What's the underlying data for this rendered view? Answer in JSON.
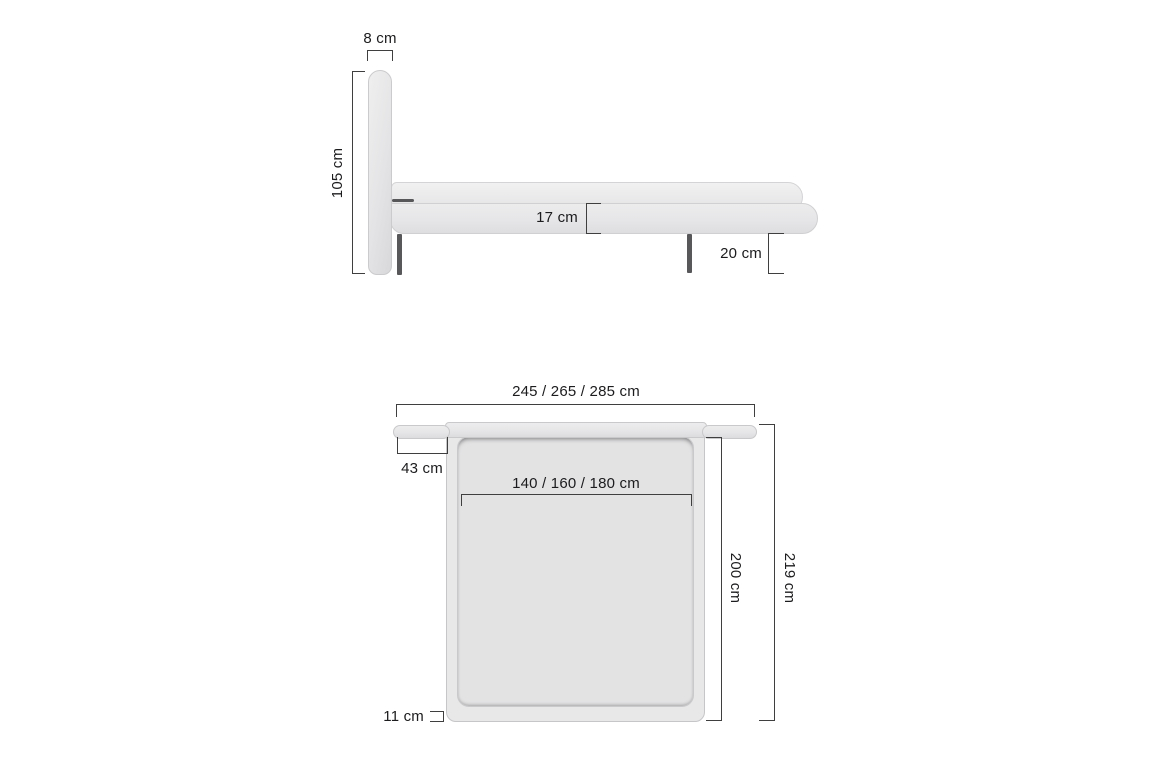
{
  "diagram": {
    "side_view": {
      "headboard_thickness": "8 cm",
      "headboard_height": "105 cm",
      "frame_side_height": "17 cm",
      "underbed_clearance": "20 cm"
    },
    "top_view": {
      "overall_width": "245 / 265 / 285 cm",
      "headboard_wing_width": "43 cm",
      "mattress_width": "140 / 160 / 180 cm",
      "mattress_length": "200 cm",
      "overall_length": "219 cm",
      "side_rail_width": "11 cm"
    },
    "colors": {
      "background": "#ffffff",
      "upholstery": "#e8e8e9",
      "mattress": "#e3e3e4",
      "leg": "#58585a",
      "dimension_line": "#3f3f3f",
      "text": "#1c1c1e"
    }
  }
}
